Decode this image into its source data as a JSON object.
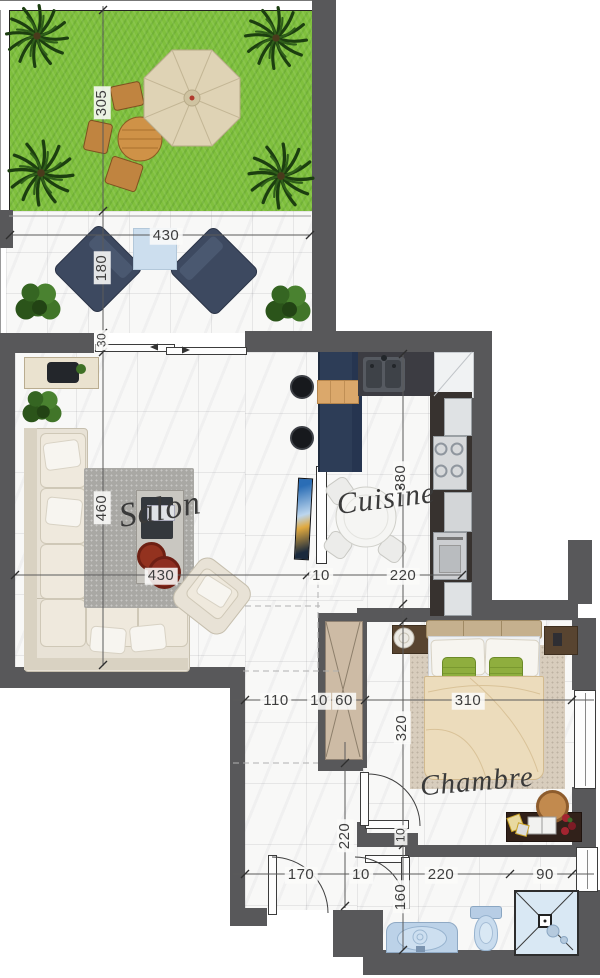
{
  "rooms": {
    "salon": "Salon",
    "cuisine": "Cuisine",
    "chambre": "Chambre"
  },
  "dims": {
    "d305": "305",
    "d430_terrace": "430",
    "d180": "180",
    "d30": "30",
    "d460": "460",
    "d430_salon": "430",
    "d10_salon": "10",
    "d220_cuisine": "220",
    "d380": "380",
    "d110": "110",
    "d10_hall": "10",
    "d60": "60",
    "d310": "310",
    "d320": "320",
    "d10_bed": "10",
    "d160": "160",
    "d220_hall": "220",
    "d170": "170",
    "d10_entry": "10",
    "d220_bath": "220",
    "d90": "90"
  },
  "colors": {
    "wall": "#58585a",
    "grass": "#7fc03d",
    "marble": "#f8f8f7",
    "island_navy": "#2d3d57",
    "sofa_beige": "#e8e2d6",
    "duvet_beige": "#ecdcbc",
    "bath_blue": "#bcd2e8",
    "accent_red": "#8e2e22",
    "pillow_green": "#8fae3e"
  }
}
